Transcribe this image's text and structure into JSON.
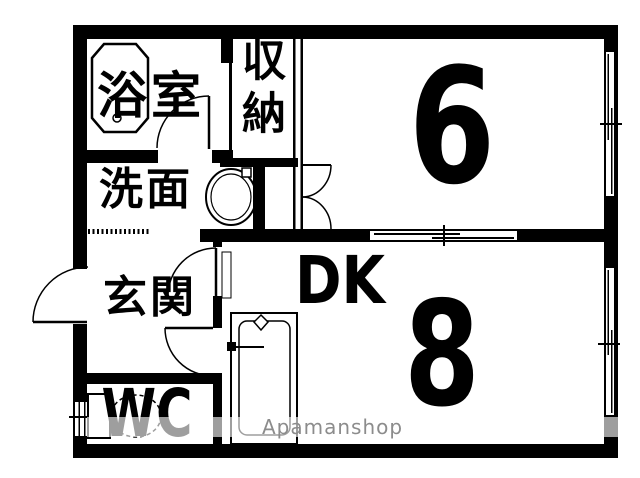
{
  "rooms": {
    "bathroom": {
      "label": "浴室"
    },
    "closet": {
      "label": "収納"
    },
    "washroom": {
      "label": "洗面"
    },
    "entrance": {
      "label": "玄関"
    },
    "wc": {
      "label": "WC"
    },
    "dining_kitchen": {
      "label": "DK",
      "size_tatami": "8"
    },
    "main_room": {
      "size_tatami": "6"
    }
  },
  "watermark": {
    "text": "Apamanshop"
  },
  "colors": {
    "wall": "#000000",
    "floor": "#ffffff",
    "watermark_text": "#8c8c8c"
  }
}
